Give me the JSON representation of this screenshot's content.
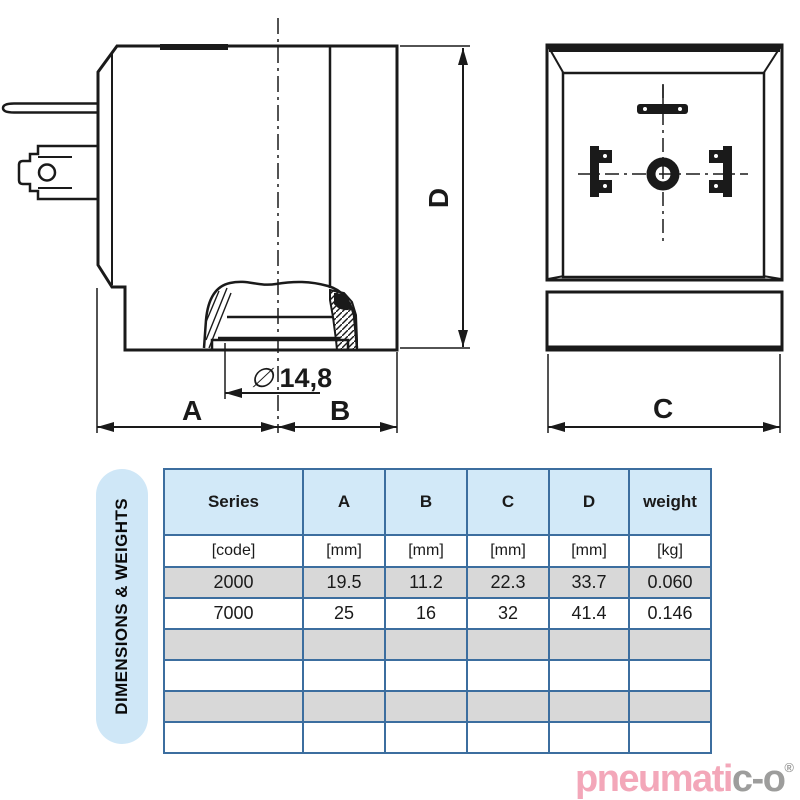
{
  "drawing": {
    "labels": {
      "a": "A",
      "b": "B",
      "c": "C",
      "d": "D",
      "diameter_symbol": "∅",
      "diameter_value": "14,8"
    }
  },
  "panel": {
    "label": "DIMENSIONS & WEIGHTS"
  },
  "table": {
    "headers": [
      "Series",
      "A",
      "B",
      "C",
      "D",
      "weight"
    ],
    "units": [
      "[code]",
      "[mm]",
      "[mm]",
      "[mm]",
      "[mm]",
      "[kg]"
    ],
    "rows": [
      [
        "2000",
        "19.5",
        "11.2",
        "22.3",
        "33.7",
        "0.060"
      ],
      [
        "7000",
        "25",
        "16",
        "32",
        "41.4",
        "0.146"
      ]
    ],
    "empty_rows": 4
  },
  "brand": {
    "primary": "pneumati",
    "secondary": "c-o",
    "registered": "®"
  },
  "colors": {
    "line": "#1a1a1a",
    "table_border": "#3c6e9f",
    "table_header_bg": "#d2e9f8",
    "table_alt_row_bg": "#d8d8d8",
    "panel_bg": "#cfe7f7",
    "brand_pink": "#f3a7b9",
    "brand_gray": "#9d9d9c"
  }
}
